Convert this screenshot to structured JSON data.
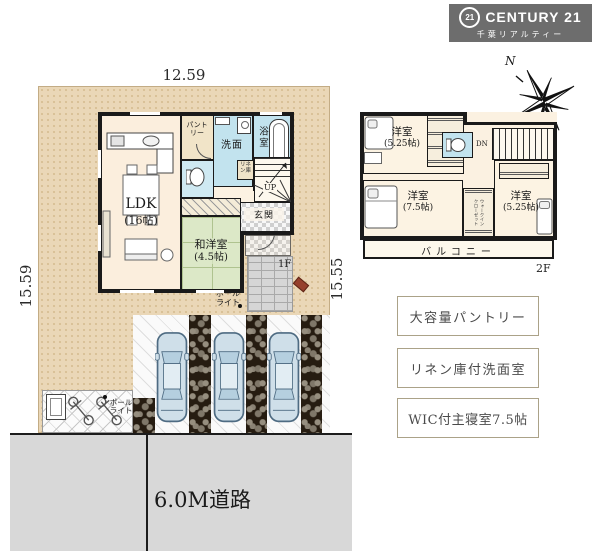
{
  "branding": {
    "seal_text": "21",
    "name": "CENTURY 21",
    "subtitle": "千葉リアルティー"
  },
  "compass": {
    "north": "N"
  },
  "dimensions": {
    "top": "12.59",
    "left": "15.59",
    "right": "15.55",
    "bottom": "12.52"
  },
  "road": {
    "label": "6.0M道路"
  },
  "floor1": {
    "floor_label": "1F",
    "ldk_name": "LDK",
    "ldk_size": "(16帖)",
    "pantry": "パントリー",
    "washroom": "洗面",
    "bathroom": "浴室",
    "linen_closet": "リネン庫",
    "stairs_label": "UP",
    "entrance": "玄関",
    "tatami_name": "和洋室",
    "tatami_size": "(4.5帖)",
    "pole_light_1": "ポール\nライト",
    "pole_light_2": "ポール\nライト"
  },
  "floor2": {
    "floor_label": "2F",
    "bedroom_top_name": "洋室",
    "bedroom_top_size": "(5.25帖)",
    "bedroom_left_name": "洋室",
    "bedroom_left_size": "(7.5帖)",
    "bedroom_right_name": "洋室",
    "bedroom_right_size": "(5.25帖)",
    "wic": "ウォークイン\nクローゼット",
    "stairs_label": "DN",
    "balcony": "バルコニー"
  },
  "features": [
    {
      "label": "大容量パントリー"
    },
    {
      "label": "リネン庫付洗面室"
    },
    {
      "label": "WIC付主寝室7.5帖"
    }
  ]
}
